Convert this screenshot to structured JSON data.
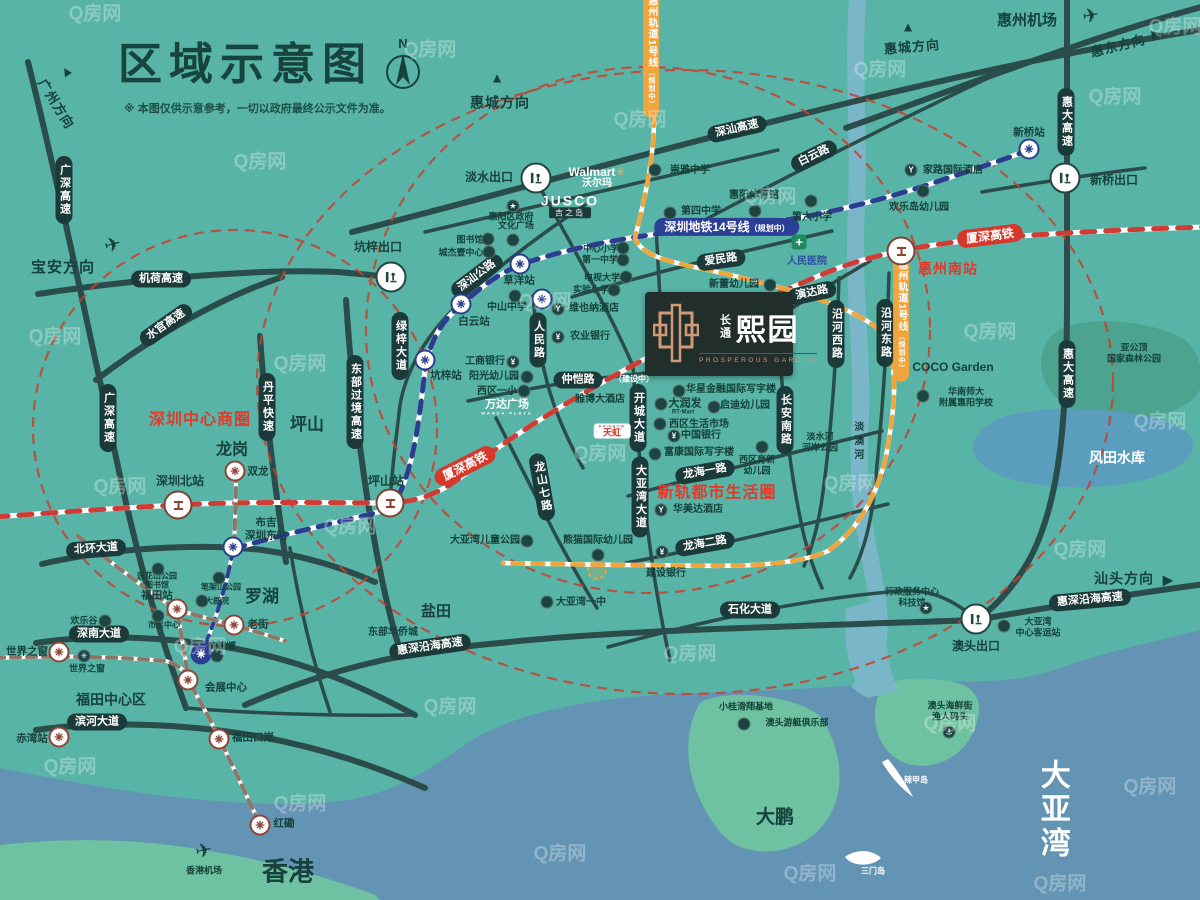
{
  "header": {
    "title": "区域示意图",
    "disclaimer": "※ 本图仅供示意参考，一切以政府最终公示文件为准。",
    "compass_n": "N"
  },
  "watermark": "Q房网",
  "project": {
    "cn_small": "长通",
    "cn_big": "熙园",
    "en": "PROSPEROUS GARDEN"
  },
  "pills": [
    {
      "t": "广深高速",
      "x": 64,
      "y": 190,
      "v": 1
    },
    {
      "t": "机荷高速",
      "x": 161,
      "y": 279
    },
    {
      "t": "水官高速",
      "x": 166,
      "y": 325,
      "r": -35
    },
    {
      "t": "广深高速",
      "x": 108,
      "y": 418,
      "v": 1
    },
    {
      "t": "丹平快速",
      "x": 267,
      "y": 407,
      "v": 1
    },
    {
      "t": "东部过境高速",
      "x": 355,
      "y": 402,
      "v": 1
    },
    {
      "t": "绿梓大道",
      "x": 400,
      "y": 346,
      "v": 1
    },
    {
      "t": "深汕公路",
      "x": 477,
      "y": 276,
      "r": -37
    },
    {
      "t": "深汕高速",
      "x": 737,
      "y": 129,
      "r": -13
    },
    {
      "t": "白云路",
      "x": 814,
      "y": 156,
      "r": -26
    },
    {
      "t": "惠大高速",
      "x": 1066,
      "y": 122,
      "v": 1
    },
    {
      "t": "惠大高速",
      "x": 1067,
      "y": 374,
      "v": 1
    },
    {
      "t": "沿河西路",
      "x": 836,
      "y": 334,
      "v": 1
    },
    {
      "t": "沿河东路",
      "x": 885,
      "y": 333,
      "v": 1
    },
    {
      "t": "人民路",
      "x": 538,
      "y": 340,
      "v": 1
    },
    {
      "t": "爱民路",
      "x": 721,
      "y": 260,
      "r": -8
    },
    {
      "t": "演达路",
      "x": 812,
      "y": 293,
      "r": -12
    },
    {
      "t": "仲恺路",
      "x": 578,
      "y": 380
    },
    {
      "t": "开城大道",
      "x": 638,
      "y": 418,
      "v": 1
    },
    {
      "t": "大亚湾大道",
      "x": 640,
      "y": 497,
      "v": 1
    },
    {
      "t": "龙山七路",
      "x": 542,
      "y": 487,
      "v": 1,
      "r": -10
    },
    {
      "t": "长安南路",
      "x": 785,
      "y": 420,
      "v": 1
    },
    {
      "t": "龙海一路",
      "x": 705,
      "y": 472,
      "r": -10
    },
    {
      "t": "龙海二路",
      "x": 705,
      "y": 544,
      "r": -10
    },
    {
      "t": "石化大道",
      "x": 750,
      "y": 610
    },
    {
      "t": "北环大道",
      "x": 96,
      "y": 549,
      "r": -4
    },
    {
      "t": "深南大道",
      "x": 99,
      "y": 634
    },
    {
      "t": "滨河大道",
      "x": 97,
      "y": 722
    },
    {
      "t": "惠深沿海高速",
      "x": 430,
      "y": 647,
      "r": -8
    },
    {
      "t": "惠深沿海高速",
      "x": 1090,
      "y": 600,
      "r": -5
    }
  ],
  "red_pills": [
    {
      "t": "厦深高铁",
      "x": 465,
      "y": 466,
      "r": -27
    },
    {
      "t": "厦深高铁",
      "x": 990,
      "y": 236,
      "r": -7
    }
  ],
  "blue_badge": {
    "t": "深圳地铁14号线",
    "s": "（规划中）",
    "x": 727,
    "y": 227
  },
  "orange_badges": [
    {
      "t": "惠州轨道1号线",
      "s": "（规划中）",
      "x": 651,
      "y": 52
    },
    {
      "t": "惠州轨道1号线",
      "s": "（规划中）",
      "x": 901,
      "y": 316
    }
  ],
  "red_texts": [
    {
      "t": "深圳中心商圈",
      "x": 200,
      "y": 421,
      "fs": 16
    },
    {
      "t": "新轨都市生活圈",
      "x": 717,
      "y": 494,
      "fs": 16
    },
    {
      "t": "惠州南站",
      "x": 948,
      "y": 269,
      "fs": 14
    }
  ],
  "big_texts": [
    {
      "t": "坪山",
      "x": 307,
      "y": 425,
      "fs": 17
    },
    {
      "t": "龙岗",
      "x": 232,
      "y": 451,
      "fs": 16
    },
    {
      "t": "罗湖",
      "x": 262,
      "y": 597,
      "fs": 17
    },
    {
      "t": "盐田",
      "x": 436,
      "y": 612,
      "fs": 15
    },
    {
      "t": "福田中心区",
      "x": 111,
      "y": 700,
      "fs": 14
    },
    {
      "t": "香港",
      "x": 288,
      "y": 872,
      "fs": 26
    },
    {
      "t": "大鹏",
      "x": 775,
      "y": 818,
      "fs": 19
    },
    {
      "t": "惠州机场",
      "x": 1027,
      "y": 21,
      "fs": 15
    },
    {
      "t": "东部华侨城",
      "x": 393,
      "y": 633,
      "fs": 10
    },
    {
      "t": "淡澳河",
      "x": 857,
      "y": 442,
      "fs": 10,
      "v": 1
    }
  ],
  "white_texts": [
    {
      "t": "大亚湾",
      "x": 1052,
      "y": 810,
      "fs": 30,
      "v": 1
    },
    {
      "t": "风田水库",
      "x": 1117,
      "y": 458,
      "fs": 14
    },
    {
      "t": "辣甲岛",
      "x": 916,
      "y": 780,
      "fs": 8
    },
    {
      "t": "三门岛",
      "x": 873,
      "y": 871,
      "fs": 8
    },
    {
      "t": "（建设中）",
      "x": 634,
      "y": 379,
      "fs": 8
    }
  ],
  "directions": [
    {
      "t": "广州方向",
      "x": 56,
      "y": 104,
      "fs": 13,
      "r": 58
    },
    {
      "t": "宝安方向",
      "x": 63,
      "y": 268,
      "fs": 15
    },
    {
      "t": "惠城方向",
      "x": 500,
      "y": 103,
      "fs": 14
    },
    {
      "t": "惠城方向",
      "x": 912,
      "y": 47,
      "fs": 13,
      "r": -5
    },
    {
      "t": "惠东方向",
      "x": 1118,
      "y": 46,
      "fs": 13,
      "r": -14
    },
    {
      "t": "汕头方向",
      "x": 1124,
      "y": 579,
      "fs": 14
    }
  ],
  "arrows": [
    {
      "ch": "▲",
      "x": 66,
      "y": 71,
      "r": -32
    },
    {
      "ch": "▲",
      "x": 497,
      "y": 78,
      "r": 0
    },
    {
      "ch": "▲",
      "x": 908,
      "y": 27,
      "r": 0
    },
    {
      "ch": "▶",
      "x": 1157,
      "y": 34,
      "r": -10
    },
    {
      "ch": "▶",
      "x": 1168,
      "y": 580,
      "r": 0
    }
  ],
  "planes": [
    {
      "ch": "✈",
      "x": 113,
      "y": 246,
      "r": -15
    },
    {
      "ch": "✈",
      "x": 1091,
      "y": 17,
      "r": -10
    },
    {
      "ch": "✈",
      "x": 204,
      "y": 852,
      "r": -12
    }
  ],
  "small_texts": [
    {
      "t": "崇雅中学",
      "x": 690,
      "y": 171
    },
    {
      "t": "家路国际酒店",
      "x": 953,
      "y": 171
    },
    {
      "t": "欢乐岛幼儿园",
      "x": 919,
      "y": 208
    },
    {
      "t": "惠阳体育馆",
      "x": 754,
      "y": 196
    },
    {
      "t": "第四中学",
      "x": 701,
      "y": 212
    },
    {
      "t": "第六小学",
      "x": 812,
      "y": 218
    },
    {
      "t": "惠阳区政府",
      "x": 511,
      "y": 217,
      "fs": 9
    },
    {
      "t": "文化广场",
      "x": 516,
      "y": 226,
      "fs": 9
    },
    {
      "t": "图书馆",
      "x": 470,
      "y": 240,
      "fs": 9
    },
    {
      "t": "城杰壹中心",
      "x": 461,
      "y": 253,
      "fs": 9
    },
    {
      "t": "中心小学",
      "x": 601,
      "y": 249,
      "fs": 9
    },
    {
      "t": "第一中学",
      "x": 600,
      "y": 260,
      "fs": 9
    },
    {
      "t": "电视大学",
      "x": 602,
      "y": 278,
      "fs": 9
    },
    {
      "t": "实验小学",
      "x": 591,
      "y": 290,
      "fs": 9
    },
    {
      "t": "中山中学",
      "x": 507,
      "y": 308
    },
    {
      "t": "维也纳酒店",
      "x": 594,
      "y": 309
    },
    {
      "t": "农业银行",
      "x": 590,
      "y": 337
    },
    {
      "t": "新蕾幼儿园",
      "x": 734,
      "y": 285
    },
    {
      "t": "华星金融国际写字楼",
      "x": 731,
      "y": 390
    },
    {
      "t": "大润发",
      "x": 685,
      "y": 404,
      "fs": 11
    },
    {
      "t": "RT-Mart",
      "x": 683,
      "y": 413,
      "fs": 6
    },
    {
      "t": "启迪幼儿园",
      "x": 745,
      "y": 406
    },
    {
      "t": "西区生活市场",
      "x": 699,
      "y": 425
    },
    {
      "t": "中国银行",
      "x": 701,
      "y": 436
    },
    {
      "t": "富康国际写字楼",
      "x": 699,
      "y": 453
    },
    {
      "t": "西区育新\n幼儿园",
      "x": 757,
      "y": 465,
      "fs": 9
    },
    {
      "t": "雅博大酒店",
      "x": 600,
      "y": 400
    },
    {
      "t": "华美达酒店",
      "x": 698,
      "y": 510
    },
    {
      "t": "工商银行",
      "x": 485,
      "y": 362
    },
    {
      "t": "阳光幼儿园",
      "x": 494,
      "y": 377
    },
    {
      "t": "西区一小",
      "x": 497,
      "y": 392
    },
    {
      "t": "熊猫国际幼儿园",
      "x": 598,
      "y": 541
    },
    {
      "t": "大亚湾儿童公园",
      "x": 485,
      "y": 541
    },
    {
      "t": "建设银行",
      "x": 666,
      "y": 574
    },
    {
      "t": "大亚湾一中",
      "x": 581,
      "y": 603
    },
    {
      "t": "行政服务中心\n科技馆",
      "x": 912,
      "y": 597,
      "fs": 9
    },
    {
      "t": "大亚湾\n中心客运站",
      "x": 1038,
      "y": 627,
      "fs": 9
    },
    {
      "t": "澳头海鲜街\n渔人码头",
      "x": 950,
      "y": 711,
      "fs": 9
    },
    {
      "t": "小桂滑翔基地",
      "x": 746,
      "y": 707,
      "fs": 9
    },
    {
      "t": "澳头游艇俱乐部",
      "x": 797,
      "y": 723,
      "fs": 9
    },
    {
      "t": "香港机场",
      "x": 204,
      "y": 871,
      "fs": 9
    },
    {
      "t": "莲花山公园\n图书馆",
      "x": 157,
      "y": 581,
      "fs": 8
    },
    {
      "t": "笔架山公园",
      "x": 221,
      "y": 587,
      "fs": 8
    },
    {
      "t": "大剧院",
      "x": 217,
      "y": 601,
      "fs": 8
    },
    {
      "t": "市民中心",
      "x": 164,
      "y": 625,
      "fs": 8
    },
    {
      "t": "欢乐谷",
      "x": 84,
      "y": 621,
      "fs": 9
    },
    {
      "t": "世界之窗",
      "x": 87,
      "y": 669,
      "fs": 9
    },
    {
      "t": "万象城",
      "x": 222,
      "y": 646,
      "fs": 8
    },
    {
      "t": "华南师大\n附属惠阳学校",
      "x": 966,
      "y": 397,
      "fs": 9
    },
    {
      "t": "淡水河\n河岸公园",
      "x": 820,
      "y": 442,
      "fs": 9
    },
    {
      "t": "亚公顶\n国家森林公园",
      "x": 1134,
      "y": 353,
      "fs": 9
    }
  ],
  "pois": [
    {
      "x": 655,
      "y": 170
    },
    {
      "x": 911,
      "y": 170,
      "g": "Y"
    },
    {
      "x": 923,
      "y": 191
    },
    {
      "x": 755,
      "y": 211
    },
    {
      "x": 670,
      "y": 213
    },
    {
      "x": 811,
      "y": 201
    },
    {
      "x": 513,
      "y": 206,
      "g": "★"
    },
    {
      "x": 513,
      "y": 240
    },
    {
      "x": 488,
      "y": 239
    },
    {
      "x": 489,
      "y": 252
    },
    {
      "x": 623,
      "y": 248
    },
    {
      "x": 623,
      "y": 260
    },
    {
      "x": 626,
      "y": 277
    },
    {
      "x": 614,
      "y": 290
    },
    {
      "x": 515,
      "y": 296
    },
    {
      "x": 558,
      "y": 309,
      "g": "Y"
    },
    {
      "x": 558,
      "y": 337,
      "g": "¥"
    },
    {
      "x": 770,
      "y": 285
    },
    {
      "x": 679,
      "y": 391
    },
    {
      "x": 661,
      "y": 404
    },
    {
      "x": 714,
      "y": 407
    },
    {
      "x": 660,
      "y": 424
    },
    {
      "x": 674,
      "y": 436,
      "g": "¥"
    },
    {
      "x": 655,
      "y": 454
    },
    {
      "x": 762,
      "y": 447
    },
    {
      "x": 661,
      "y": 510,
      "g": "Y"
    },
    {
      "x": 513,
      "y": 362,
      "g": "¥"
    },
    {
      "x": 527,
      "y": 377
    },
    {
      "x": 524,
      "y": 391
    },
    {
      "x": 598,
      "y": 555
    },
    {
      "x": 527,
      "y": 541
    },
    {
      "x": 662,
      "y": 552,
      "g": "¥"
    },
    {
      "x": 547,
      "y": 602
    },
    {
      "x": 926,
      "y": 608,
      "g": "★"
    },
    {
      "x": 1004,
      "y": 626
    },
    {
      "x": 949,
      "y": 732,
      "g": "⚓"
    },
    {
      "x": 744,
      "y": 724
    },
    {
      "x": 158,
      "y": 569
    },
    {
      "x": 219,
      "y": 578
    },
    {
      "x": 202,
      "y": 601
    },
    {
      "x": 158,
      "y": 616
    },
    {
      "x": 105,
      "y": 621
    },
    {
      "x": 84,
      "y": 656,
      "g": "✳"
    },
    {
      "x": 217,
      "y": 656
    },
    {
      "x": 923,
      "y": 396
    }
  ],
  "hospital": {
    "t": "人民医院",
    "x": 807,
    "y": 262,
    "ix": 799,
    "iy": 242
  },
  "brands": {
    "walmart": {
      "t": "Walmart",
      "spark": "✳",
      "cn": "沃尔玛",
      "x": 597,
      "y": 172
    },
    "jusco": {
      "t": "JUSCO",
      "cn": "吉之岛",
      "x": 570,
      "y": 201
    },
    "wanda": {
      "t": "万达广场",
      "s": "WANDA PLAZA",
      "x": 507,
      "y": 405
    },
    "tianhong": {
      "t": "天虹",
      "s": "RAINBOW",
      "x": 612,
      "y": 431
    },
    "coco": {
      "t": "COCO Garden",
      "x": 953,
      "y": 367
    }
  },
  "metro_stations": [
    {
      "t": "白云站",
      "x": 461,
      "y": 304,
      "lx": 474,
      "ly": 322,
      "c": "n"
    },
    {
      "t": "草洋站",
      "x": 520,
      "y": 264,
      "lx": 519,
      "ly": 281,
      "c": "n"
    },
    {
      "t": "",
      "x": 542,
      "y": 299,
      "c": "n"
    },
    {
      "t": "坑梓站",
      "x": 425,
      "y": 360,
      "lx": 446,
      "ly": 376,
      "c": "n"
    },
    {
      "t": "新桥站",
      "x": 1029,
      "y": 149,
      "lx": 1029,
      "ly": 133,
      "c": "n"
    },
    {
      "t": "双龙",
      "x": 235,
      "y": 471,
      "lx": 258,
      "ly": 472,
      "c": "b"
    },
    {
      "t": "布吉\n深圳东站",
      "x": 233,
      "y": 547,
      "lx": 266,
      "ly": 529,
      "c": "n"
    },
    {
      "t": "老街",
      "x": 234,
      "y": 625,
      "lx": 258,
      "ly": 625,
      "c": "b"
    },
    {
      "t": "万象城",
      "x": 201,
      "y": 654,
      "lx": 224,
      "ly": 646,
      "c": "d",
      "hide": 1
    },
    {
      "t": "会展中心",
      "x": 188,
      "y": 680,
      "lx": 226,
      "ly": 688,
      "c": "b"
    },
    {
      "t": "福田站",
      "x": 177,
      "y": 609,
      "lx": 157,
      "ly": 596,
      "c": "b"
    },
    {
      "t": "世界之窗",
      "x": 59,
      "y": 652,
      "lx": 27,
      "ly": 652,
      "c": "b"
    },
    {
      "t": "赤湾站",
      "x": 59,
      "y": 737,
      "lx": 32,
      "ly": 739,
      "c": "b"
    },
    {
      "t": "福田口岸",
      "x": 219,
      "y": 739,
      "lx": 253,
      "ly": 738,
      "c": "b"
    },
    {
      "t": "红磡",
      "x": 260,
      "y": 825,
      "lx": 284,
      "ly": 824,
      "c": "b"
    }
  ],
  "rail_stations": [
    {
      "t": "深圳北站",
      "x": 178,
      "y": 505,
      "lx": 180,
      "ly": 481
    },
    {
      "t": "坪山站",
      "x": 390,
      "y": 503,
      "lx": 386,
      "ly": 481
    },
    {
      "t": "",
      "x": 901,
      "y": 251
    }
  ],
  "exits": [
    {
      "t": "淡水出口",
      "x": 536,
      "y": 178,
      "lx": 489,
      "ly": 177
    },
    {
      "t": "坑梓出口",
      "x": 391,
      "y": 277,
      "lx": 378,
      "ly": 247
    },
    {
      "t": "新桥出口",
      "x": 1065,
      "y": 178,
      "lx": 1114,
      "ly": 180
    },
    {
      "t": "澳头出口",
      "x": 976,
      "y": 619,
      "lx": 976,
      "ly": 646
    }
  ],
  "watermarks": [
    [
      95,
      12
    ],
    [
      260,
      160
    ],
    [
      430,
      48
    ],
    [
      640,
      118
    ],
    [
      880,
      68
    ],
    [
      1115,
      95
    ],
    [
      55,
      335
    ],
    [
      300,
      362
    ],
    [
      545,
      300
    ],
    [
      770,
      195
    ],
    [
      990,
      330
    ],
    [
      1160,
      420
    ],
    [
      120,
      485
    ],
    [
      350,
      525
    ],
    [
      600,
      452
    ],
    [
      850,
      482
    ],
    [
      1080,
      548
    ],
    [
      200,
      645
    ],
    [
      450,
      705
    ],
    [
      690,
      652
    ],
    [
      950,
      722
    ],
    [
      1150,
      785
    ],
    [
      300,
      802
    ],
    [
      560,
      852
    ],
    [
      810,
      872
    ],
    [
      1060,
      882
    ],
    [
      70,
      765
    ],
    [
      1175,
      25
    ]
  ]
}
